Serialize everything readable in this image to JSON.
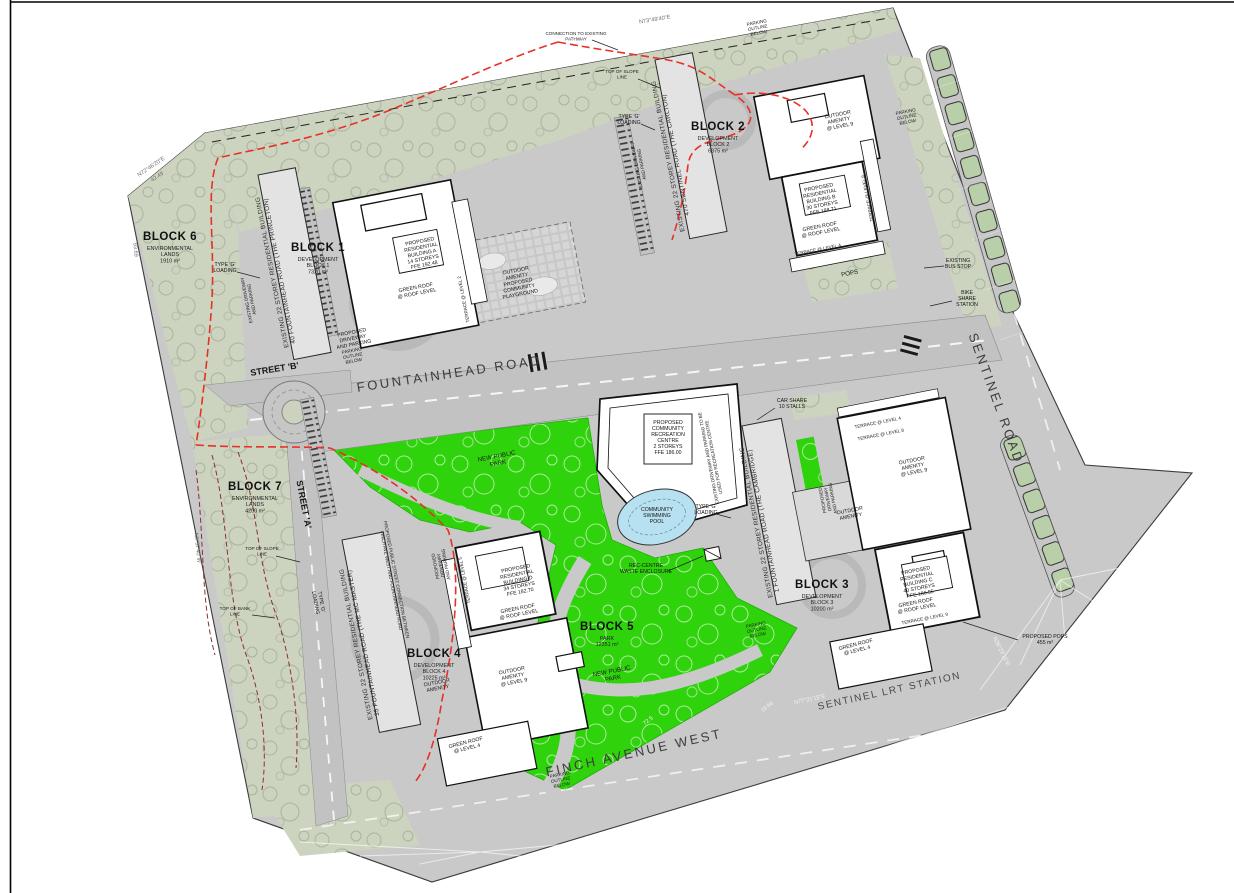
{
  "drawing": {
    "roads": {
      "fountainhead": "FOUNTAINHEAD ROAD",
      "sentinel": "SENTINEL ROAD",
      "finch": "FINCH AVENUE WEST",
      "lrt_station": "SENTINEL LRT STATION",
      "street_a": "STREET 'A'",
      "street_b": "STREET 'B'",
      "street_a_note": [
        "PROPOSED PUBLIC STREET CONNECTION BETWEEN",
        "FINCH AVE WEST AND FOUNTAINHEAD ROAD"
      ]
    },
    "blocks": {
      "b1_title": "BLOCK 1",
      "b1_sub": [
        "DEVELOPMENT",
        "BLOCK 1",
        "7320 m²"
      ],
      "b2_title": "BLOCK 2",
      "b2_sub": [
        "DEVELOPMENT",
        "BLOCK 2",
        "6375 m²"
      ],
      "b3_title": "BLOCK 3",
      "b3_sub": [
        "DEVELOPMENT",
        "BLOCK 3",
        "10200 m²"
      ],
      "b4_title": "BLOCK 4",
      "b4_sub": [
        "DEVELOPMENT",
        "BLOCK 4",
        "10225 m²"
      ],
      "b5_title": "BLOCK 5",
      "b5_sub": [
        "PARK",
        "12351 m²"
      ],
      "b6_title": "BLOCK 6",
      "b6_sub": [
        "ENVIRONMENTAL",
        "LANDS",
        "1910 m²"
      ],
      "b7_title": "BLOCK 7",
      "b7_sub": [
        "ENVIRONMENTAL",
        "LANDS",
        "4200 m²"
      ]
    },
    "existing": {
      "princeton": [
        "EXISTING 22 STOREY RESIDENTIAL BUILDING",
        "40 FOUNTAINHEAD ROAD (THE PRINCETON)"
      ],
      "carlton": [
        "EXISTING 22 STOREY RESIDENTIAL BUILDING",
        "470 SENTINEL ROAD (THE CARLTON)"
      ],
      "cambridge": [
        "EXISTING 22 STOREY RESIDENTIAL BUILDING",
        "1 FOUNTAINHEAD ROAD (THE CAMBRIDGE)"
      ],
      "mcmaster": [
        "EXISTING 22 STOREY RESIDENTIAL BUILDING",
        "35 FOUNTAINHEAD ROAD (THE MC MASTER)"
      ]
    },
    "proposed": {
      "bldg_a": [
        "PROPOSED",
        "RESIDENTIAL",
        "BUILDING A",
        "14 STOREYS",
        "FFE 192.48"
      ],
      "bldg_b": [
        "PROPOSED",
        "RESIDENTIAL",
        "BUILDING B",
        "30 STOREYS",
        "FFE 188.71"
      ],
      "bldg_c": [
        "PROPOSED",
        "RESIDENTIAL",
        "BUILDING C",
        "40 STOREYS",
        "FFE 186.55"
      ],
      "bldg_d": [
        "PROPOSED",
        "RESIDENTIAL",
        "BUILDING D",
        "34 STOREYS",
        "FFE 182.70"
      ],
      "rec_centre": [
        "PROPOSED",
        "COMMUNITY",
        "RECREATION",
        "CENTRE",
        "2 STOREYS",
        "FFE 186.00"
      ],
      "pool": [
        "COMMUNITY",
        "SWIMMING",
        "POOL"
      ]
    },
    "features": {
      "green_roof_roof": [
        "GREEN ROOF",
        "@ ROOF LEVEL"
      ],
      "green_roof_l4": [
        "GREEN ROOF",
        "@ LEVEL 4"
      ],
      "outdoor_amenity_l9": [
        "OUTDOOR",
        "AMENITY",
        "@ LEVEL 9"
      ],
      "outdoor_amenity": [
        "OUTDOOR",
        "AMENITY"
      ],
      "playground": [
        "OUTDOOR",
        "AMENITY",
        "PROPOSED",
        "COMMUNITY",
        "PLAYGROUND"
      ],
      "terrace_l2": "TERRACE @ LEVEL 2",
      "terrace_l4": "TERRACE @ LEVEL 4",
      "terrace_l5": "TERRACE @ LEVEL 5",
      "terrace_l8": "TERRACE @ LEVEL 8",
      "terrace_l9": "TERRACE @ LEVEL 9"
    },
    "notes": {
      "type_g_loading": [
        "TYPE 'G'",
        "LOADING"
      ],
      "car_share": [
        "CAR SHARE",
        "10 STALLS"
      ],
      "bus_stop": [
        "EXISTING",
        "BUS STOP"
      ],
      "bike_share": [
        "BIKE",
        "SHARE",
        "STATION"
      ],
      "pops": "POPS",
      "proposed_pops": [
        "PROPOSED POPS",
        "455 m²"
      ],
      "parking_outline": [
        "PARKING",
        "OUTLINE",
        "BELOW"
      ],
      "waste_enclosure": [
        "REC-CENTRE",
        "WASTE ENCLOSURE"
      ],
      "new_public_park": [
        "NEW PUBLIC",
        "PARK"
      ],
      "existing_driveway": [
        "EXISTING DRIVEWAY",
        "AND PARKING"
      ],
      "rec_driveway": [
        "EXISTING DRIVEWAY AND PARKING TO BE",
        "USED FOR RECREATION CENTRE"
      ],
      "proposed_driveway": [
        "PROPOSED",
        "DRIVEWAY",
        "AND PARKING"
      ],
      "top_of_bank": [
        "TOP OF BANK",
        "LINE"
      ],
      "top_of_slope": [
        "TOP OF SLOPE",
        "LINE"
      ],
      "pathway_connection": [
        "CONNECTION TO EXISTING",
        "PATHWAY"
      ]
    },
    "survey": {
      "bearing_nw": "N72°46'20\"E",
      "dim_nw": "42.49",
      "dim_w": "93.69",
      "bearing_w": "N9°57'40\"W",
      "bearing_top": "N73°49'40\"E",
      "bearing_finch": "N77°21'15\"E",
      "bearing_lrt": "N38°23'15\"E",
      "dim_72": "72.5",
      "dim_18": "18.66"
    }
  }
}
